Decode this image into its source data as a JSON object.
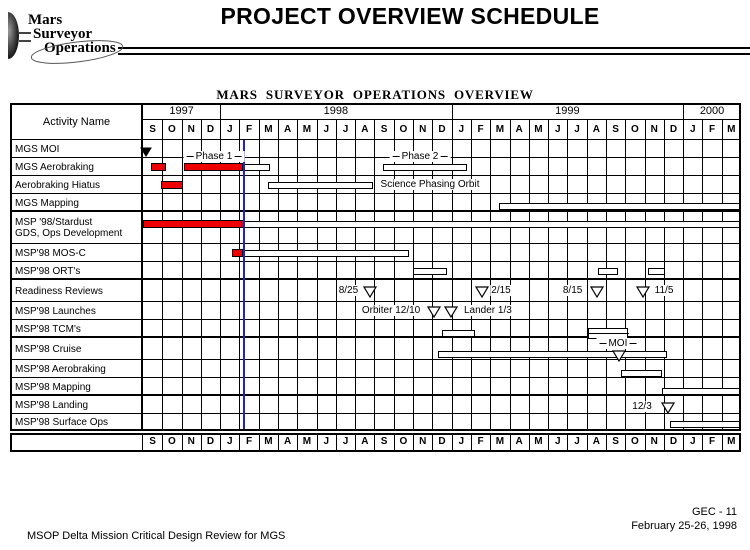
{
  "page": {
    "title": "PROJECT OVERVIEW SCHEDULE",
    "logo": {
      "line1": "Mars",
      "line2": "Surveyor",
      "line3": "Operations"
    },
    "footer_left": "MSOP Delta Mission Critical Design Review for MGS",
    "footer_right_line1": "GEC - 11",
    "footer_right_line2": "February 25-26, 1998"
  },
  "colors": {
    "completed_bar": "#EE0000",
    "planned_bar": "#FFFFFF",
    "bar_border": "#000000",
    "status_line": "#2222CC",
    "grid": "#000000"
  },
  "chart_data": {
    "type": "bar",
    "subtype": "gantt-schedule",
    "title": "MARS  SURVEYOR  OPERATIONS  OVERVIEW",
    "activity_header": "Activity Name",
    "time_axis": {
      "origin": "Sep 1997",
      "unit": "months since Sep 1997",
      "years": [
        {
          "label": "1997",
          "months": [
            "S",
            "O",
            "N",
            "D"
          ]
        },
        {
          "label": "1998",
          "months": [
            "J",
            "F",
            "M",
            "A",
            "M",
            "J",
            "J",
            "A",
            "S",
            "O",
            "N",
            "D"
          ]
        },
        {
          "label": "1999",
          "months": [
            "J",
            "F",
            "M",
            "A",
            "M",
            "J",
            "J",
            "A",
            "S",
            "O",
            "N",
            "D"
          ]
        },
        {
          "label": "2000",
          "months": [
            "J",
            "F",
            "M"
          ]
        }
      ],
      "repeated_at_bottom": true
    },
    "status_line_month": 5.24,
    "rows": [
      {
        "label": [
          "MGS MOI"
        ],
        "h": 18,
        "items": [
          {
            "t": "milestone",
            "style": "filled",
            "m": 0.18,
            "dy": 0
          }
        ]
      },
      {
        "label": [
          "MGS Aerobraking"
        ],
        "h": 18,
        "items": [
          {
            "t": "bar",
            "style": "complete",
            "from": 0.41,
            "to": 1.17,
            "dy": 0
          },
          {
            "t": "bar",
            "style": "complete",
            "from": 2.13,
            "to": 5.21,
            "dy": 0
          },
          {
            "t": "bar",
            "style": "planned",
            "from": 5.21,
            "to": 6.58,
            "dy": 0
          },
          {
            "t": "label",
            "text": "Phase 1",
            "dashes": true,
            "m": 3.68,
            "dy": -10
          },
          {
            "t": "bar",
            "style": "planned",
            "from": 12.44,
            "to": 16.8,
            "dy": 0
          },
          {
            "t": "label",
            "text": "Phase 2",
            "dashes": true,
            "m": 14.36,
            "dy": -10
          }
        ]
      },
      {
        "label": [
          "Aerobraking Hiatus"
        ],
        "h": 18,
        "items": [
          {
            "t": "bar",
            "style": "complete",
            "from": 0.93,
            "to": 2.07,
            "dy": 0
          },
          {
            "t": "bar",
            "style": "planned",
            "from": 6.48,
            "to": 11.92,
            "dy": 0
          },
          {
            "t": "label",
            "text": "Science Phasing Orbit",
            "m": 14.88,
            "dy": 0
          }
        ]
      },
      {
        "label": [
          "MGS Mapping"
        ],
        "h": 18,
        "thick_bottom": true,
        "items": [
          {
            "t": "bar",
            "style": "planned",
            "from": 18.45,
            "to": 31,
            "dy": 3
          }
        ]
      },
      {
        "label": [
          "MSP '98/Stardust",
          "GDS, Ops Development"
        ],
        "h": 32,
        "items": [
          {
            "t": "bar",
            "style": "complete",
            "from": 0,
            "to": 5.21,
            "dy": -4
          },
          {
            "t": "bar",
            "style": "planned",
            "from": 5.21,
            "to": 31,
            "dy": -4
          }
        ]
      },
      {
        "label": [
          "MSP'98 MOS-C"
        ],
        "h": 18,
        "items": [
          {
            "t": "bar",
            "style": "complete",
            "from": 4.61,
            "to": 5.21,
            "dy": 0
          },
          {
            "t": "bar",
            "style": "planned",
            "from": 5.21,
            "to": 13.79,
            "dy": 0
          }
        ]
      },
      {
        "label": [
          "MSP'98 ORT's"
        ],
        "h": 18,
        "thick_bottom": true,
        "items": [
          {
            "t": "bar",
            "style": "planned",
            "from": 14.0,
            "to": 15.76,
            "dy": 0
          },
          {
            "t": "bar",
            "style": "planned",
            "from": 23.59,
            "to": 24.62,
            "dy": 0
          },
          {
            "t": "bar",
            "style": "planned",
            "from": 26.18,
            "to": 27.06,
            "dy": 0
          }
        ]
      },
      {
        "label": [
          "Readiness Reviews"
        ],
        "h": 22,
        "items": [
          {
            "t": "label",
            "text": "8/25",
            "m": 10.65,
            "dy": 0
          },
          {
            "t": "milestone",
            "style": "open",
            "m": 11.77,
            "dy": 0
          },
          {
            "t": "milestone",
            "style": "open",
            "m": 17.57,
            "dy": 0
          },
          {
            "t": "label",
            "text": "2/15",
            "m": 18.56,
            "dy": 0
          },
          {
            "t": "label",
            "text": "8/15",
            "m": 22.27,
            "dy": 0
          },
          {
            "t": "milestone",
            "style": "open",
            "m": 23.54,
            "dy": 0
          },
          {
            "t": "milestone",
            "style": "open",
            "m": 25.92,
            "dy": 0
          },
          {
            "t": "label",
            "text": "11/5",
            "m": 27.01,
            "dy": 0
          }
        ]
      },
      {
        "label": [
          "MSP'98 Launches"
        ],
        "h": 18,
        "items": [
          {
            "t": "label",
            "text": "Orbiter 12/10",
            "m": 12.86,
            "dy": 0
          },
          {
            "t": "milestone",
            "style": "open",
            "m": 15.08,
            "dy": 0
          },
          {
            "t": "milestone",
            "style": "open",
            "m": 15.97,
            "dy": 0
          },
          {
            "t": "label",
            "text": "Lander 1/3",
            "m": 17.88,
            "dy": 0
          }
        ]
      },
      {
        "label": [
          "MSP'98 TCM's"
        ],
        "h": 18,
        "thick_bottom": true,
        "items": [
          {
            "t": "bar",
            "style": "planned",
            "from": 15.5,
            "to": 17.21,
            "dy": 4
          },
          {
            "t": "bar",
            "style": "double",
            "from": 23.07,
            "to": 25.14,
            "dy": 4
          }
        ]
      },
      {
        "label": [
          "MSP'98 Cruise"
        ],
        "h": 22,
        "items": [
          {
            "t": "bar",
            "style": "planned",
            "from": 15.29,
            "to": 27.17,
            "dy": 5
          },
          {
            "t": "label",
            "text": "MOI",
            "dashes": true,
            "m": 24.62,
            "dy": -5
          },
          {
            "t": "milestone",
            "style": "open",
            "m": 24.68,
            "dy": 6
          }
        ]
      },
      {
        "label": [
          "MSP'98 Aerobraking"
        ],
        "h": 18,
        "items": [
          {
            "t": "bar",
            "style": "planned",
            "from": 24.78,
            "to": 26.9,
            "dy": 4
          }
        ]
      },
      {
        "label": [
          "MSP'98 Mapping"
        ],
        "h": 18,
        "thick_bottom": true,
        "items": [
          {
            "t": "bar",
            "style": "planned",
            "from": 26.9,
            "to": 31,
            "dy": 4
          }
        ]
      },
      {
        "label": [
          "MSP'98 Landing"
        ],
        "h": 18,
        "items": [
          {
            "t": "label",
            "text": "12/3",
            "m": 25.87,
            "dy": 2
          },
          {
            "t": "milestone",
            "style": "open",
            "m": 27.19,
            "dy": 2
          }
        ]
      },
      {
        "label": [
          "MSP'98 Surface Ops"
        ],
        "h": 17,
        "items": [
          {
            "t": "bar",
            "style": "planned",
            "from": 27.32,
            "to": 31,
            "dy": 2
          }
        ]
      }
    ]
  }
}
